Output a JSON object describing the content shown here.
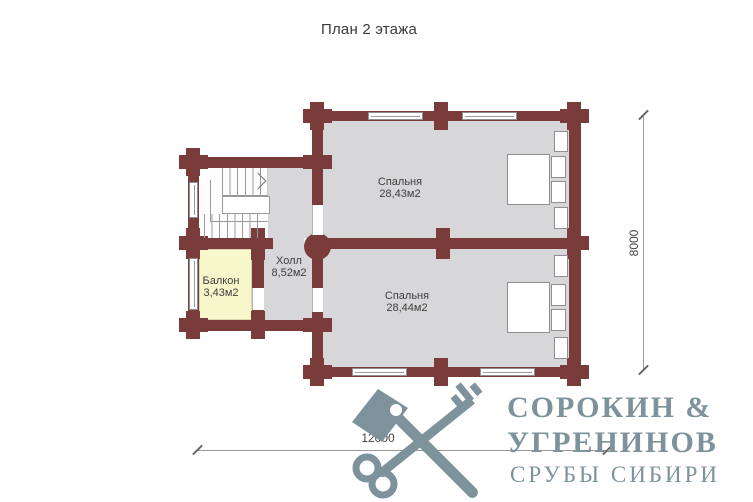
{
  "title": "План 2 этажа",
  "rooms": [
    {
      "name": "Спальня",
      "area": "28,43м2"
    },
    {
      "name": "Спальня",
      "area": "28,44м2"
    },
    {
      "name": "Холл",
      "area": "8,52м2"
    },
    {
      "name": "Балкон",
      "area": "3,43м2"
    }
  ],
  "dimensions": {
    "width": "12000",
    "height": "8000"
  },
  "logo": {
    "line1": "СОРОКИН &",
    "line2": "УГРЕНИНОВ",
    "line3": "СРУБЫ СИБИРИ"
  },
  "colors": {
    "wall": "#7a3b3b",
    "floor": "#d7d6d8",
    "balcony": "#f8f6cb",
    "logo": "#7d929b",
    "text": "#3a3a3a"
  }
}
